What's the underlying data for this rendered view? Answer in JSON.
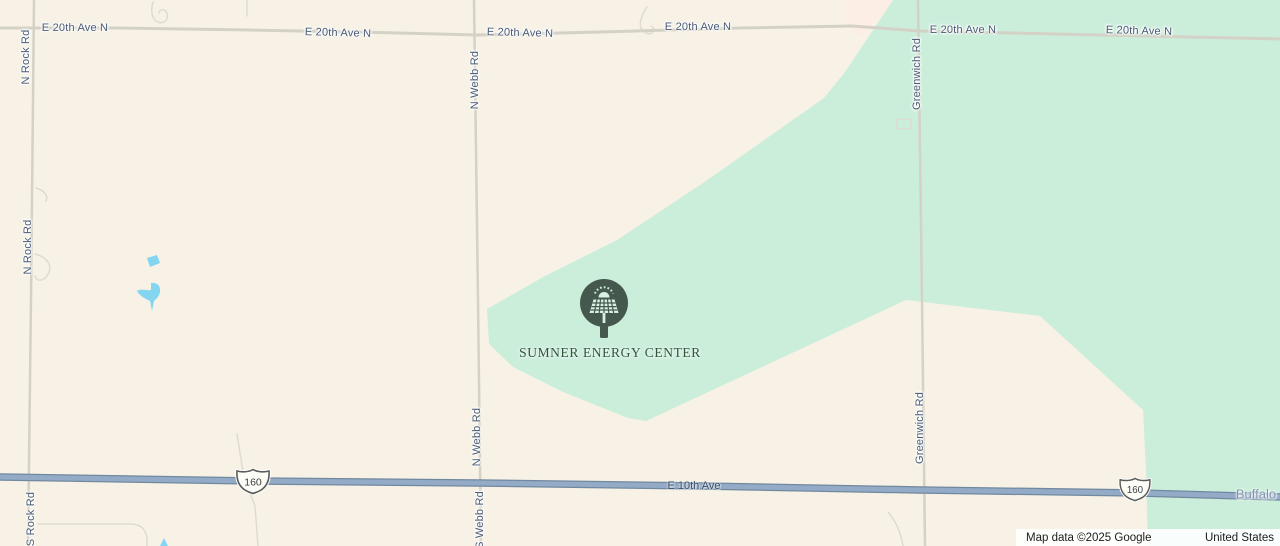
{
  "map": {
    "title": "Sumner Energy Center map view"
  },
  "colors": {
    "map_base": "#f7f2e5",
    "aoi_tint": "#fceee4",
    "greenspace": "#cbeedb",
    "water": "#84d5ef",
    "minor_road": "#d4d1c6",
    "faint_road": "#dedbd2",
    "highway_casing": "#72889f",
    "highway_fill": "#94abc7",
    "road_label": "#4a5b76",
    "highway_label": "#3b4d63",
    "town_label": "#7e98ab",
    "poi_label": "#2d5638",
    "marker_bg": "#44584e",
    "marker_glyph": "#d8efe3",
    "attribution_bg": "rgba(255,255,255,0.88)",
    "attribution_text": "#1c1c1c"
  },
  "roads": {
    "e20_name": "E 20th Ave N",
    "rock_n_name": "N Rock Rd",
    "rock_s_name": "S Rock Rd",
    "webb_n_name": "N Webb Rd",
    "webb_s_name": "S Webb Rd",
    "greenwich_name": "Greenwich Rd",
    "e10_name": "E 10th Ave",
    "route_shield": "160"
  },
  "places": {
    "energy_center": "SUMNER ENERGY CENTER",
    "town": "Buffalo"
  },
  "marker": {
    "icon": "solar-panel-marker-icon"
  },
  "attribution": {
    "map_data": "Map data ©2025 Google",
    "region": "United States"
  }
}
